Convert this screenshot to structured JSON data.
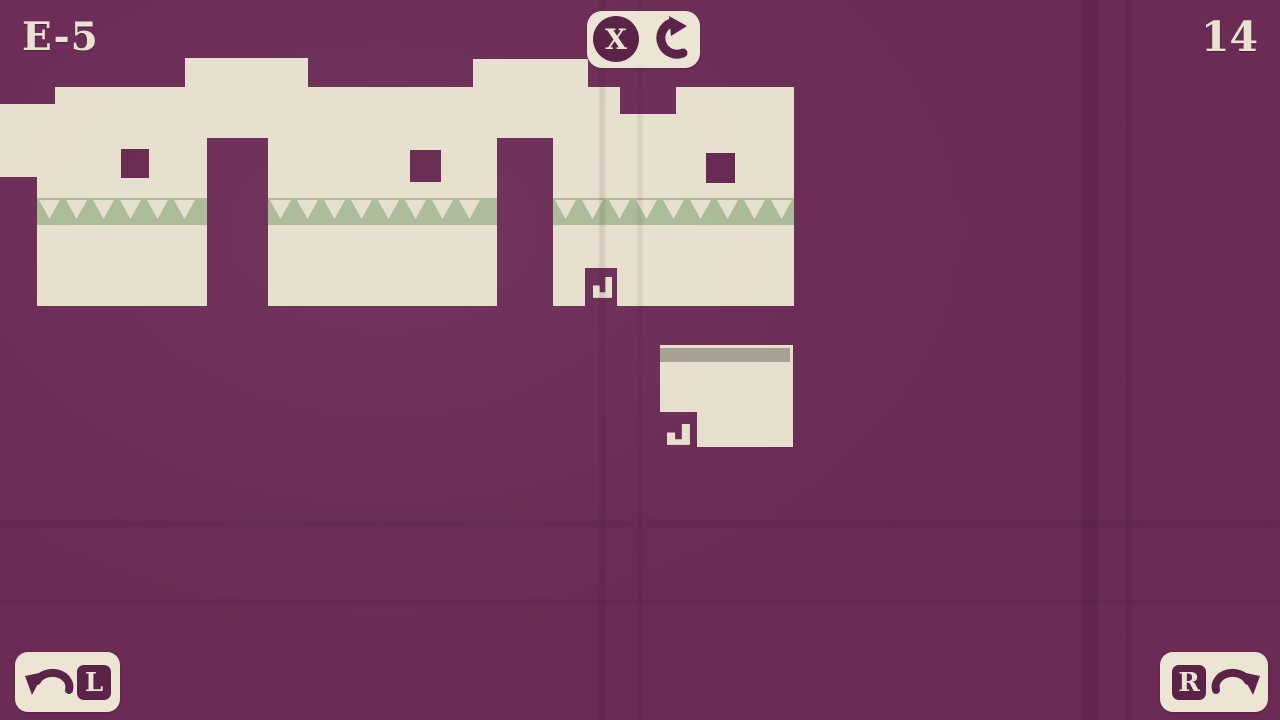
{
  "colors": {
    "bg": "#6a2b55",
    "hole": "#652750",
    "cream": "#e7dfcd",
    "cream-bright": "#ece5d4",
    "plum-dark": "#5c2348",
    "green": "#a9ba98",
    "gray": "#a6a092",
    "text": "#e9e2d1"
  },
  "hud": {
    "level": "E-5",
    "moves": "14",
    "restart_key": "X",
    "left_key": "L",
    "right_key": "R"
  },
  "icons": {
    "restart": "rotate-cw-icon",
    "left": "rotate-ccw-arrow-icon",
    "right": "rotate-cw-arrow-icon",
    "pivot": "hook-icon"
  },
  "game": {
    "terrain_points": "0,104 55,104 55,87 185,87 185,58 308,58 308,87 473,87 473,59 588,59 588,87 620,87 620,114 676,114 676,87 794,87 794,306 617,306 617,268 585,268 585,306 553,306 553,138 497,138 497,306 268,306 268,138 207,138 207,306 37,306 37,177 0,177",
    "holes": [
      {
        "x": 121,
        "y": 149,
        "w": 28,
        "h": 29
      },
      {
        "x": 410,
        "y": 150,
        "w": 31,
        "h": 32
      },
      {
        "x": 706,
        "y": 153,
        "w": 29,
        "h": 30
      }
    ],
    "bands": [
      {
        "x": 37,
        "y": 198,
        "w": 170,
        "h": 27
      },
      {
        "x": 268,
        "y": 198,
        "w": 229,
        "h": 27
      },
      {
        "x": 553,
        "y": 198,
        "w": 241,
        "h": 27
      }
    ],
    "band_pattern": {
      "inset": 2,
      "width": 21,
      "height": 19,
      "top": 200,
      "period": 27
    },
    "block_points": "660,345 793,345 793,447 697,447 697,412 660,412",
    "block_strip": {
      "x": 660,
      "y": 348,
      "w": 130,
      "h": 14
    },
    "hooks": [
      {
        "transform": "translate(593,277) scale(1.12,0.95)"
      },
      {
        "transform": "translate(667,424) scale(1.35,0.95)"
      }
    ]
  }
}
